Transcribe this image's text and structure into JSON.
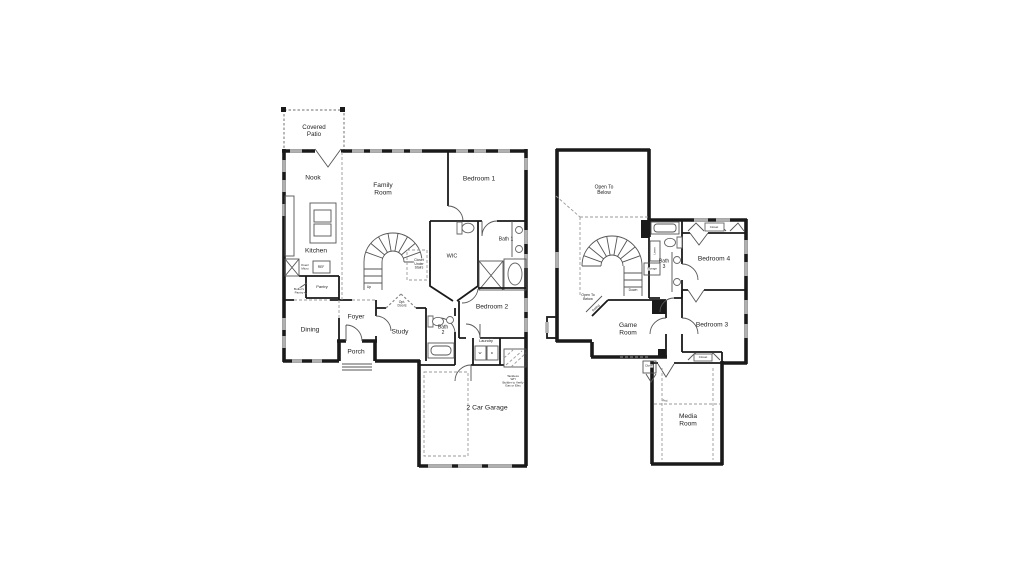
{
  "title": "Two-story house floor plan",
  "colors": {
    "wall": "#1a1a1a",
    "window": "#b0b0b0",
    "dash": "#9a9a9a",
    "ink": "#222222"
  },
  "first_floor": {
    "rooms": {
      "covered_patio": "Covered\nPatio",
      "nook": "Nook",
      "family_room": "Family\nRoom",
      "bedroom_1": "Bedroom 1",
      "kitchen": "Kitchen",
      "bath_1": "Bath 1",
      "wic": "WIC",
      "closet_under_stairs": "Closet\nUnder\nStairs",
      "up": "Up",
      "oven_micro": "Oven/\nMicro",
      "ref": "REF",
      "pantry": "Pantry",
      "butlers_pantry": "Butler's\nPantry",
      "dining": "Dining",
      "foyer": "Foyer",
      "opt_doors": "Opt.\nDoors",
      "study": "Study",
      "bath_2": "Bath\n2",
      "bedroom_2": "Bedroom 2",
      "laundry": "Laundry",
      "washer": "W",
      "dryer": "D",
      "porch": "Porch",
      "tankless_wh": "Tankless\nWH\nBuilder to Verify\nGas or Elec",
      "garage": "2 Car Garage"
    }
  },
  "second_floor": {
    "rooms": {
      "open_to_below_main": "Open To\nBelow",
      "open_to_below_stair": "Open To\nBelow",
      "down": "Down",
      "railing": "Railing",
      "linen": "Linen",
      "storage": "Storage",
      "bath_3": "Bath\n3",
      "closet_bedroom_4": "Closet",
      "bedroom_4": "Bedroom 4",
      "game_room": "Game\nRoom",
      "bedroom_3": "Bedroom 3",
      "closet_bedroom_3": "Closet",
      "closet_media": "Closet",
      "media_room": "Media\nRoom",
      "proj": "Proj"
    }
  }
}
